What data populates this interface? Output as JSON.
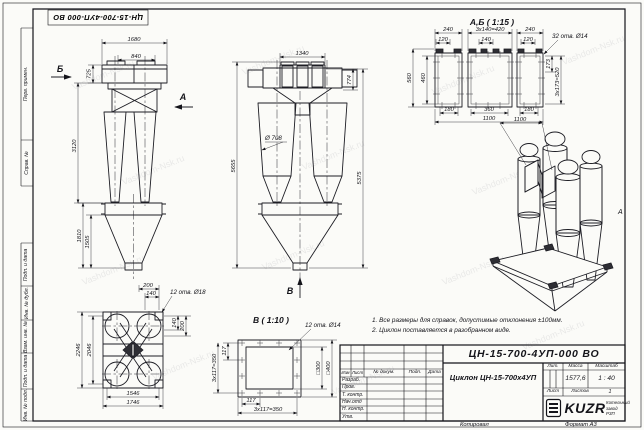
{
  "watermark": "Vashdom-Nsk.ru",
  "stamp": "ЦН-15-700-4УП-000 ВО",
  "zone_marker": "А",
  "margin_labels": [
    "Перв. примен.",
    "Справ. №",
    "Подп. и дата",
    "Инв. № дубл.",
    "Взам. инв. №",
    "Подп. и дата",
    "Инв. № подл."
  ],
  "views": {
    "side": {
      "dim_1680": "1680",
      "dim_840": "840",
      "dim_725": "725",
      "dim_3120": "3120",
      "dim_1810": "1810",
      "dim_1505": "1505",
      "arrow_b": "Б",
      "arrow_a": "А"
    },
    "front": {
      "dim_1340": "1340",
      "dim_774": "774",
      "dia_708": "Ø 708",
      "dim_5655": "5655",
      "dim_5375": "5375",
      "arrow_v": "В"
    },
    "detail_ab": {
      "title": "А,Б ( 1:15 )",
      "dim_240l": "240",
      "dim_420": "3х140=420",
      "dim_240r": "240",
      "dim_120l": "120",
      "dim_140": "140",
      "dim_120r": "120",
      "holes": "32 отв. Ø14",
      "dim_560": "560",
      "dim_460": "460",
      "dim_173": "173",
      "dim_520": "3х173=520",
      "dim_180l": "180",
      "dim_360": "360",
      "dim_180r": "180",
      "dim_1100": "1100"
    },
    "plan": {
      "dim_200t": "200",
      "dim_140t": "140",
      "holes": "12 отв. Ø18",
      "dim_140r": "140",
      "dim_200r": "200",
      "dim_2246": "2246",
      "dim_2046": "2046",
      "dim_1546": "1546",
      "dim_1746": "1746"
    },
    "detail_v": {
      "title": "В ( 1:10 )",
      "holes": "12 отв. Ø14",
      "dim_300": "□300",
      "dim_400": "□400",
      "dim_117b": "117",
      "dim_350b": "3х117=350",
      "dim_117l": "117",
      "dim_350l": "3х117=350"
    },
    "iso": {
      "dim_1100": "1100"
    }
  },
  "notes": {
    "line1": "1. Все размеры для справок, допустимые отклонения ±100мм.",
    "line2": "2. Циклон поставляется в разобранном виде."
  },
  "title_block": {
    "designation": "ЦН-15-700-4УП-000 ВО",
    "product_title": "Циклон ЦН-15-700х4УП",
    "columns": {
      "izm": "Изм",
      "list": "Лист",
      "doc": "№ докум.",
      "podp": "Подп.",
      "data": "Дата"
    },
    "rows": [
      "Разраб.",
      "Пров.",
      "Т. контр.",
      "Нач.отд",
      "Н. контр.",
      "Утв."
    ],
    "lit_label": "Лит.",
    "mass_label": "Масса",
    "scale_label": "Масштаб",
    "mass_value": "1577,6",
    "scale_value": "1 : 40",
    "sheet_label": "Лист",
    "sheets_label": "Листов",
    "sheets_value": "1",
    "logo_text": "KUZR",
    "company_line1": "Котельный",
    "company_line2": "завод РЗП",
    "copied_label": "Копировал",
    "format_label": "Формат А3"
  }
}
